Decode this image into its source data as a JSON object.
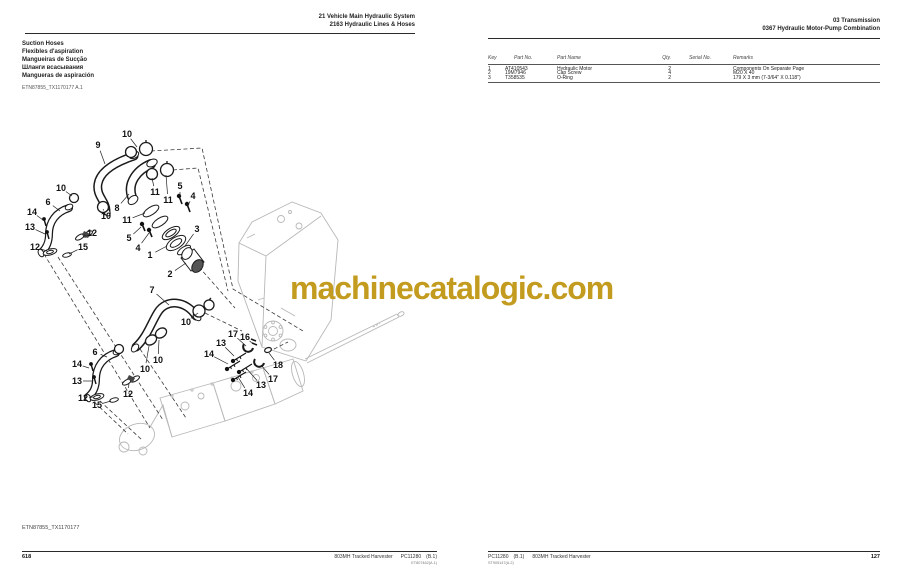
{
  "watermark": {
    "text": "machinecatalogic.com",
    "color": "#c39b1e"
  },
  "left_page": {
    "header": {
      "line1": "21  Vehicle Main Hydraulic System",
      "line2": "2163  Hydraulic Lines & Hoses"
    },
    "titles": [
      "Suction Hoses",
      "Flexibles d'aspiration",
      "Mangueiras de Sucção",
      "Шланги всасывания",
      "Mangueras de aspiración"
    ],
    "figure_ref": "ETN87855_TX1170177 A.1",
    "figure_ref_bottom": "ETN87855_TX1170177",
    "footer": {
      "model": "803MH Tracked Harvester",
      "catalog": "PC11280",
      "revision": "(B.1)",
      "sub_ref": "ET807462(A.1)",
      "page_number": "618"
    },
    "callouts": [
      {
        "n": "10",
        "x": 127,
        "y": 134,
        "tx": 137,
        "ty": 147
      },
      {
        "n": "9",
        "x": 98,
        "y": 145,
        "tx": 105,
        "ty": 164
      },
      {
        "n": "10",
        "x": 61,
        "y": 188,
        "tx": 72,
        "ty": 196
      },
      {
        "n": "6",
        "x": 48,
        "y": 202,
        "tx": 60,
        "ty": 211
      },
      {
        "n": "14",
        "x": 32,
        "y": 212,
        "tx": 43,
        "ty": 220
      },
      {
        "n": "13",
        "x": 30,
        "y": 227,
        "tx": 45,
        "ty": 234
      },
      {
        "n": "12",
        "x": 35,
        "y": 247,
        "tx": 47,
        "ty": 251
      },
      {
        "n": "15",
        "x": 83,
        "y": 247,
        "tx": 69,
        "ty": 254
      },
      {
        "n": "12",
        "x": 92,
        "y": 233,
        "tx": 84,
        "ty": 236
      },
      {
        "n": "10",
        "x": 106,
        "y": 216,
        "tx": 103,
        "ty": 209
      },
      {
        "n": "8",
        "x": 117,
        "y": 208,
        "tx": 129,
        "ty": 194
      },
      {
        "n": "11",
        "x": 155,
        "y": 192,
        "tx": 152,
        "ty": 178
      },
      {
        "n": "11",
        "x": 168,
        "y": 200,
        "tx": 166,
        "ty": 175
      },
      {
        "n": "11",
        "x": 127,
        "y": 220,
        "tx": 145,
        "ty": 213
      },
      {
        "n": "5",
        "x": 180,
        "y": 186,
        "tx": 180,
        "ty": 196
      },
      {
        "n": "4",
        "x": 193,
        "y": 196,
        "tx": 188,
        "ty": 205
      },
      {
        "n": "5",
        "x": 129,
        "y": 238,
        "tx": 141,
        "ty": 227
      },
      {
        "n": "4",
        "x": 138,
        "y": 248,
        "tx": 149,
        "ty": 233
      },
      {
        "n": "1",
        "x": 150,
        "y": 255,
        "tx": 167,
        "ty": 246
      },
      {
        "n": "3",
        "x": 197,
        "y": 229,
        "tx": 185,
        "ty": 246
      },
      {
        "n": "2",
        "x": 170,
        "y": 274,
        "tx": 186,
        "ty": 263
      },
      {
        "n": "7",
        "x": 152,
        "y": 290,
        "tx": 169,
        "ty": 305
      },
      {
        "n": "10",
        "x": 186,
        "y": 322,
        "tx": 198,
        "ty": 313
      },
      {
        "n": "10",
        "x": 158,
        "y": 360,
        "tx": 159,
        "ty": 340
      },
      {
        "n": "10",
        "x": 145,
        "y": 369,
        "tx": 149,
        "ty": 346
      },
      {
        "n": "6",
        "x": 95,
        "y": 352,
        "tx": 107,
        "ty": 357
      },
      {
        "n": "14",
        "x": 77,
        "y": 364,
        "tx": 89,
        "ty": 368
      },
      {
        "n": "13",
        "x": 77,
        "y": 381,
        "tx": 92,
        "ty": 381
      },
      {
        "n": "12",
        "x": 83,
        "y": 398,
        "tx": 94,
        "ty": 397
      },
      {
        "n": "15",
        "x": 97,
        "y": 405,
        "tx": 111,
        "ty": 401
      },
      {
        "n": "12",
        "x": 128,
        "y": 394,
        "tx": 129,
        "ty": 383
      },
      {
        "n": "17",
        "x": 233,
        "y": 334,
        "tx": 246,
        "ty": 346
      },
      {
        "n": "16",
        "x": 245,
        "y": 337,
        "tx": 252,
        "ty": 343
      },
      {
        "n": "13",
        "x": 221,
        "y": 343,
        "tx": 234,
        "ty": 356
      },
      {
        "n": "14",
        "x": 209,
        "y": 354,
        "tx": 228,
        "ty": 364
      },
      {
        "n": "18",
        "x": 278,
        "y": 365,
        "tx": 269,
        "ty": 353
      },
      {
        "n": "17",
        "x": 273,
        "y": 379,
        "tx": 261,
        "ty": 365
      },
      {
        "n": "13",
        "x": 261,
        "y": 385,
        "tx": 246,
        "ty": 368
      },
      {
        "n": "14",
        "x": 248,
        "y": 393,
        "tx": 238,
        "ty": 377
      }
    ]
  },
  "right_page": {
    "header": {
      "line1": "03  Transmission",
      "line2": "0367  Hydraulic Motor-Pump Combination"
    },
    "table": {
      "columns": [
        "Key",
        "Part No.",
        "Part Name",
        "Qty.",
        "Serial No.",
        "Remarks"
      ],
      "rows": [
        {
          "key": "1",
          "part_no": "AT410543",
          "part_name": "Hydraulic Motor",
          "qty": "2",
          "serial_no": "",
          "remarks": "Components On Separate Page"
        },
        {
          "key": "2",
          "part_no": "19M7946",
          "part_name": "Cap Screw",
          "qty": "4",
          "serial_no": "",
          "remarks": "M20 X 40"
        },
        {
          "key": "3",
          "part_no": "T358535",
          "part_name": "O-Ring",
          "qty": "2",
          "serial_no": "",
          "remarks": "179 X 3 mm (7-3/64\" X 0.118\")"
        }
      ]
    },
    "footer": {
      "catalog": "PC11280",
      "revision": "(B.1)",
      "model": "803MH Tracked Harvester",
      "sub_ref": "ST905147(A.2)",
      "page_number": "127"
    }
  }
}
